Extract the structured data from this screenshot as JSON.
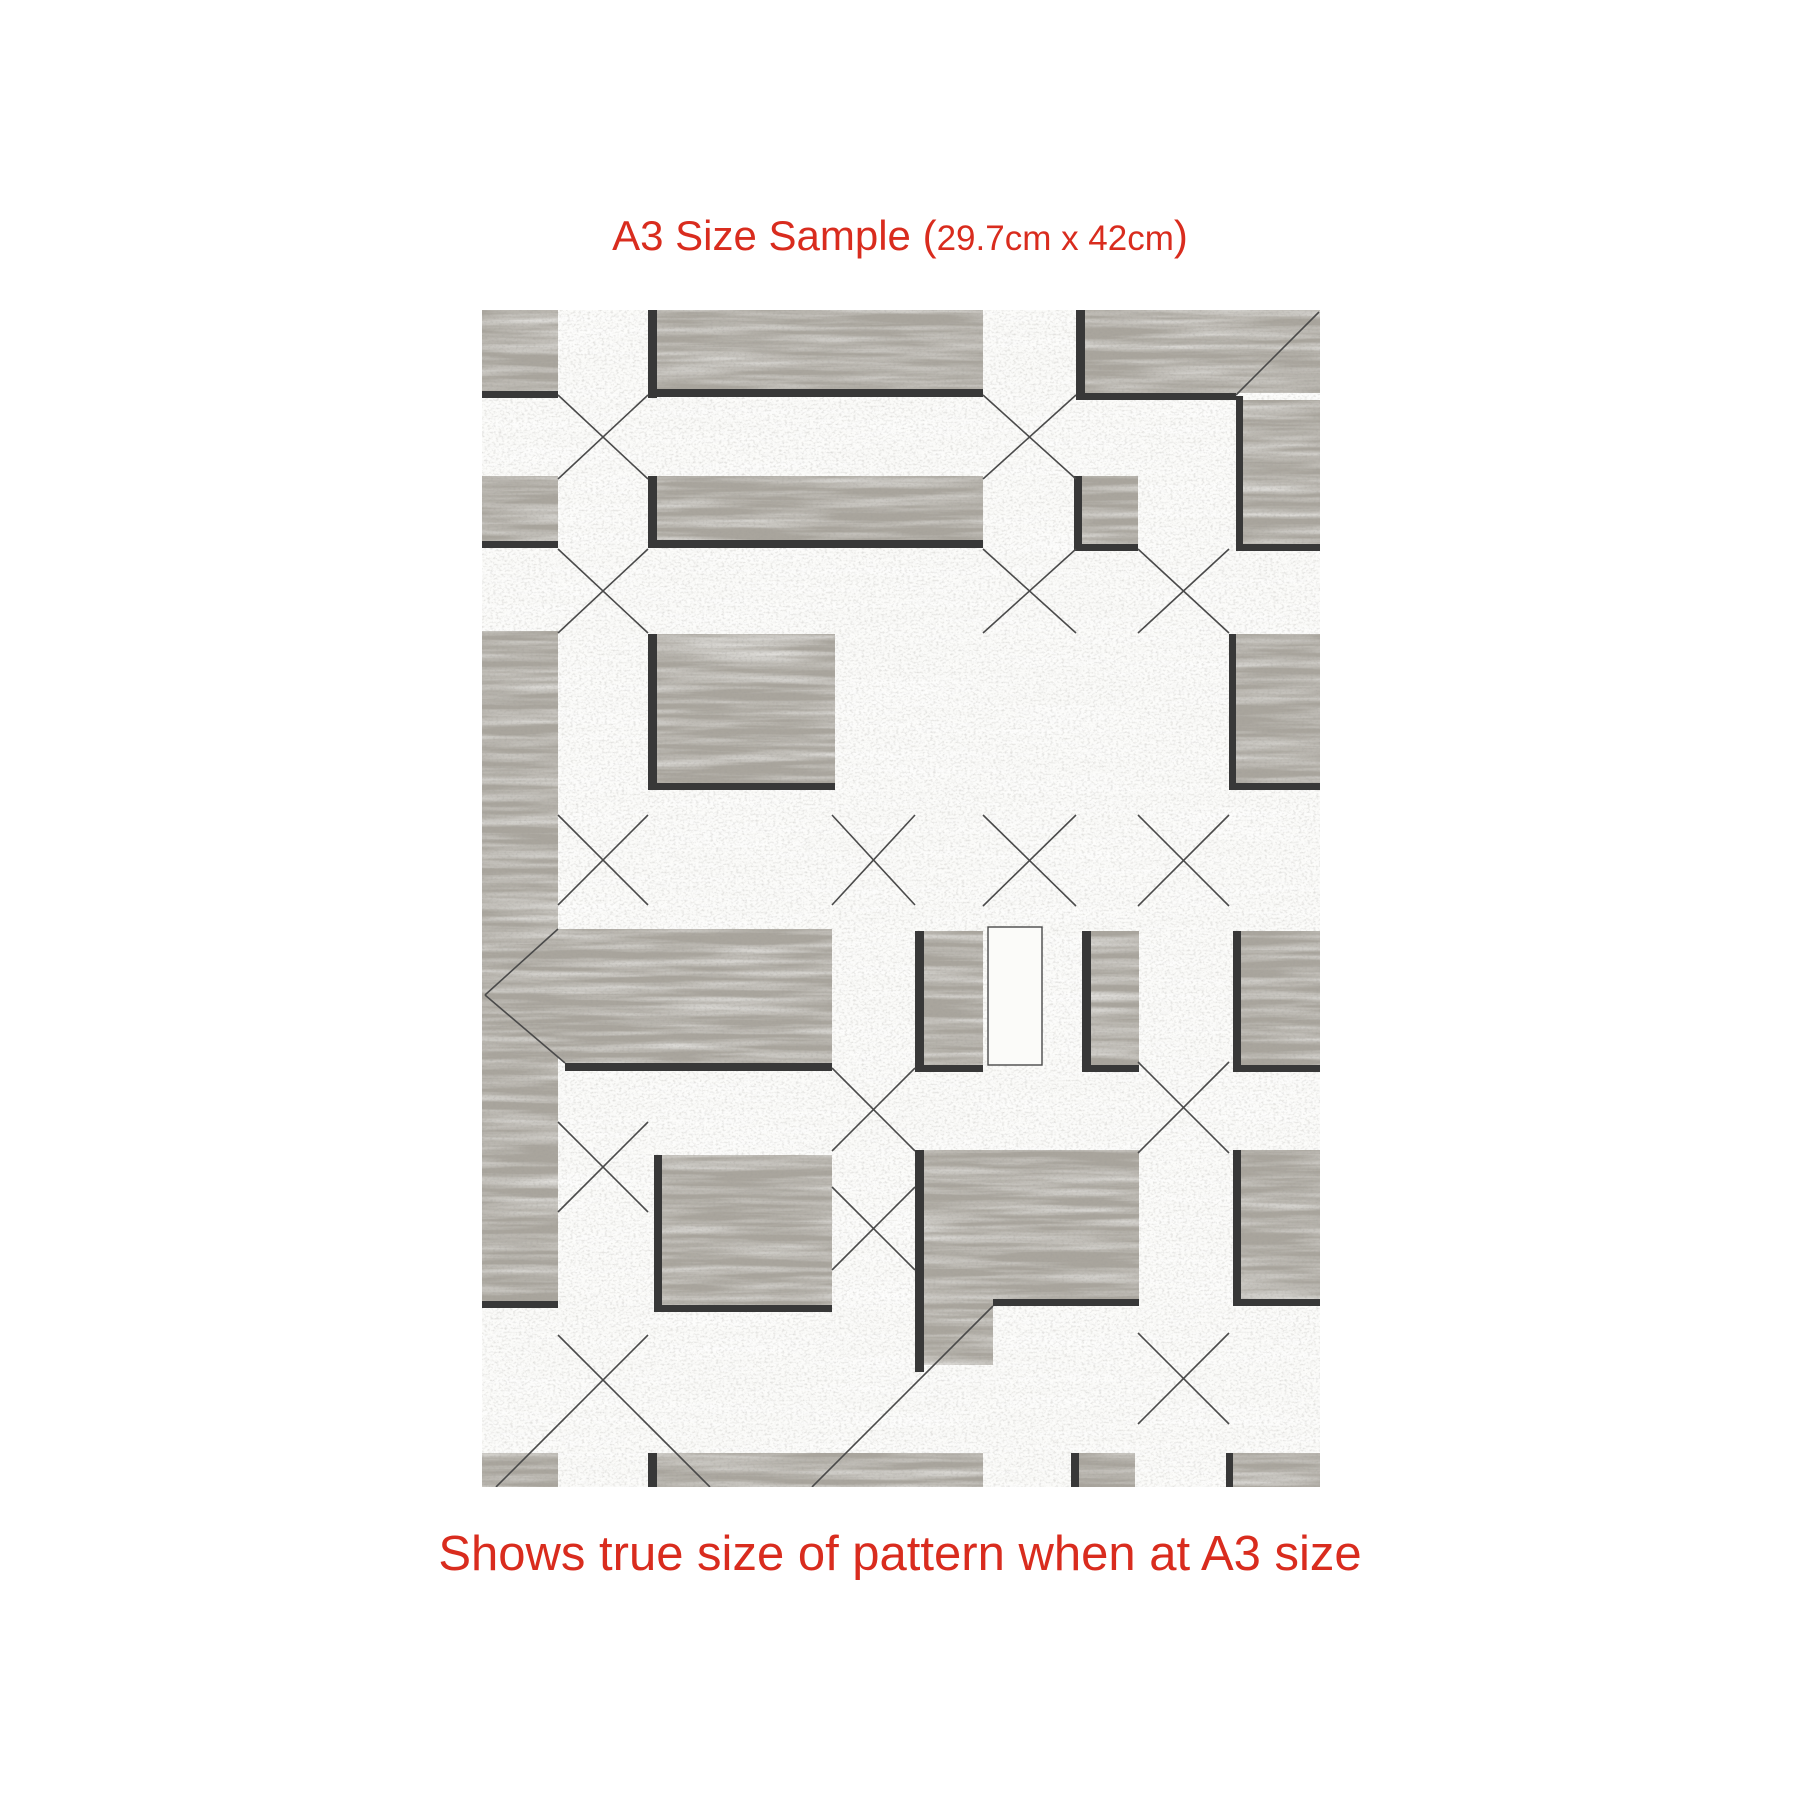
{
  "header": {
    "title_main": "A3 Size Sample (",
    "title_dims": "29.7cm x 42cm",
    "title_close": ")",
    "accent_color": "#d92c1e"
  },
  "footer": {
    "caption": "Shows true size of pattern when at A3 size"
  },
  "sample": {
    "description": "distressed wood parquet geometric pattern swatch",
    "geometry": {
      "x": 482,
      "y": 310,
      "width": 838,
      "height": 1177
    },
    "colors": {
      "panel_gray": "#a9a59d",
      "panel_white": "#fbfbf9",
      "band_black": "#383838",
      "seam_line": "#4a4a4a",
      "speck_dark": "#55534e"
    },
    "gray_rects": [
      [
        0,
        0,
        76,
        81
      ],
      [
        0,
        166,
        76,
        65
      ],
      [
        0,
        321,
        76,
        670
      ],
      [
        0,
        1143,
        76,
        34
      ],
      [
        175,
        0,
        326,
        79
      ],
      [
        175,
        166,
        326,
        64
      ],
      [
        175,
        324,
        178,
        149
      ],
      [
        180,
        845,
        170,
        150
      ],
      [
        175,
        1143,
        326,
        34
      ],
      [
        603,
        0,
        235,
        83
      ],
      [
        600,
        166,
        56,
        68
      ],
      [
        761,
        90,
        77,
        144
      ],
      [
        754,
        324,
        84,
        149
      ],
      [
        442,
        621,
        59,
        134
      ],
      [
        609,
        621,
        48,
        134
      ],
      [
        759,
        621,
        79,
        134
      ],
      [
        442,
        840,
        215,
        149
      ],
      [
        442,
        989,
        69,
        66
      ],
      [
        759,
        840,
        79,
        149
      ],
      [
        597,
        1143,
        56,
        34
      ],
      [
        751,
        1143,
        87,
        34
      ]
    ],
    "gray_polys": [
      [
        [
          3,
          685
        ],
        [
          76,
          619
        ],
        [
          350,
          619
        ],
        [
          350,
          753
        ],
        [
          83,
          753
        ]
      ]
    ],
    "black_bands": [
      [
        166,
        0,
        9,
        88
      ],
      [
        166,
        166,
        9,
        72
      ],
      [
        166,
        324,
        9,
        156
      ],
      [
        594,
        0,
        9,
        90
      ],
      [
        592,
        166,
        8,
        75
      ],
      [
        754,
        86,
        7,
        155
      ],
      [
        747,
        324,
        7,
        156
      ],
      [
        433,
        621,
        9,
        141
      ],
      [
        600,
        621,
        9,
        141
      ],
      [
        751,
        621,
        8,
        141
      ],
      [
        433,
        840,
        9,
        222
      ],
      [
        751,
        840,
        8,
        156
      ],
      [
        172,
        845,
        8,
        157
      ],
      [
        166,
        1143,
        9,
        34
      ],
      [
        589,
        1143,
        8,
        34
      ],
      [
        744,
        1143,
        7,
        34
      ],
      [
        0,
        81,
        76,
        7
      ],
      [
        166,
        79,
        335,
        8
      ],
      [
        0,
        231,
        76,
        7
      ],
      [
        166,
        230,
        335,
        8
      ],
      [
        594,
        83,
        160,
        7
      ],
      [
        754,
        234,
        84,
        7
      ],
      [
        592,
        234,
        64,
        7
      ],
      [
        166,
        473,
        187,
        7
      ],
      [
        747,
        473,
        91,
        7
      ],
      [
        83,
        753,
        267,
        8
      ],
      [
        433,
        755,
        68,
        7
      ],
      [
        600,
        755,
        57,
        7
      ],
      [
        751,
        755,
        87,
        7
      ],
      [
        0,
        991,
        76,
        7
      ],
      [
        511,
        989,
        146,
        7
      ],
      [
        751,
        989,
        87,
        7
      ],
      [
        172,
        995,
        178,
        7
      ]
    ],
    "white_rects": [
      [
        506,
        617,
        54,
        138
      ]
    ],
    "seams": [
      [
        76,
        85,
        166,
        169
      ],
      [
        166,
        85,
        76,
        169
      ],
      [
        76,
        239,
        166,
        323
      ],
      [
        166,
        239,
        76,
        323
      ],
      [
        501,
        85,
        594,
        169
      ],
      [
        594,
        85,
        501,
        169
      ],
      [
        501,
        239,
        594,
        323
      ],
      [
        594,
        239,
        501,
        323
      ],
      [
        656,
        239,
        747,
        323
      ],
      [
        747,
        239,
        656,
        323
      ],
      [
        754,
        85,
        837,
        2
      ],
      [
        76,
        505,
        166,
        595
      ],
      [
        166,
        505,
        76,
        595
      ],
      [
        350,
        505,
        433,
        595
      ],
      [
        433,
        505,
        350,
        595
      ],
      [
        501,
        505,
        594,
        596
      ],
      [
        594,
        505,
        501,
        596
      ],
      [
        656,
        505,
        747,
        596
      ],
      [
        747,
        505,
        656,
        596
      ],
      [
        3,
        685,
        76,
        619
      ],
      [
        3,
        685,
        83,
        753
      ],
      [
        350,
        758,
        433,
        841
      ],
      [
        433,
        758,
        350,
        841
      ],
      [
        656,
        752,
        747,
        843
      ],
      [
        747,
        752,
        656,
        843
      ],
      [
        76,
        812,
        166,
        902
      ],
      [
        166,
        812,
        76,
        902
      ],
      [
        350,
        877,
        433,
        960
      ],
      [
        433,
        877,
        350,
        960
      ],
      [
        76,
        1025,
        166,
        1115
      ],
      [
        166,
        1025,
        76,
        1115
      ],
      [
        656,
        1023,
        747,
        1114
      ],
      [
        747,
        1023,
        656,
        1114
      ],
      [
        166,
        1115,
        228,
        1177
      ],
      [
        76,
        1115,
        14,
        1177
      ],
      [
        511,
        996,
        330,
        1177
      ]
    ]
  }
}
